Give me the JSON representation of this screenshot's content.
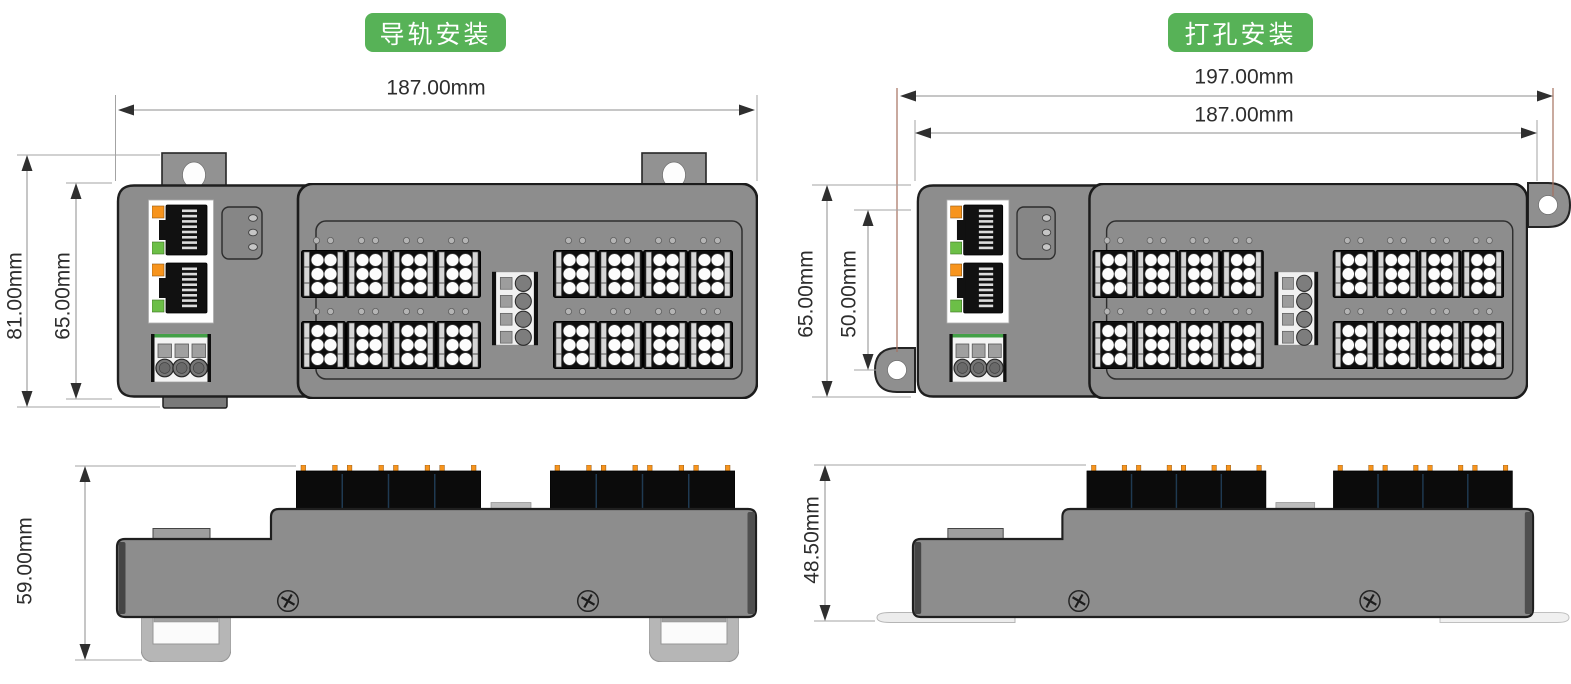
{
  "left_assembly": {
    "badge": "导轨安装",
    "front": {
      "width": "187.00mm",
      "height_outer": "81.00mm",
      "height_body": "65.00mm"
    },
    "bottom": {
      "height": "59.00mm"
    }
  },
  "right_assembly": {
    "badge": "打孔安装",
    "front": {
      "width_outer": "197.00mm",
      "width_body": "187.00mm",
      "height_body": "65.00mm",
      "hole_spacing": "50.00mm"
    },
    "bottom": {
      "height": "48.50mm"
    }
  },
  "colors": {
    "badge_green": "#57b257",
    "led_orange": "#f7941d",
    "led_green": "#6cbf47",
    "device_gray": "#8d8d8d",
    "extension_line_red": "#a5705f",
    "dimension_text": "#2d2d2d"
  }
}
